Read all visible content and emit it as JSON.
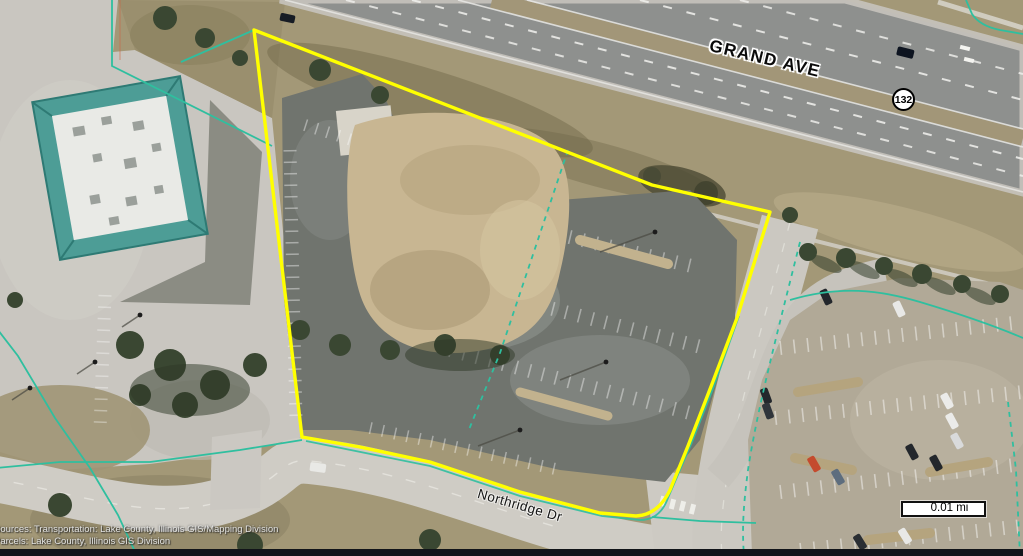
{
  "map": {
    "street_labels": {
      "grand_ave": "GRAND AVE",
      "northridge_dr": "Northridge Dr"
    },
    "route_shield": {
      "number": "132"
    },
    "scale_bar": {
      "label": "0.01 mi"
    },
    "attribution": {
      "line1": "Sources: Transportation: Lake County, Illinois GIS/Mapping Division",
      "line2": "Parcels: Lake County, Illinois GIS Division"
    },
    "colors": {
      "parcel_highlight_outline": "#ffff00",
      "parcel_boundary_lines": "#2fbf9f",
      "route_shield_fill": "#ffffff",
      "route_shield_border": "#000000",
      "street_label_text": "#000000",
      "street_label_halo": "#ffffff",
      "scale_bar_fill": "#ffffff",
      "scale_bar_border": "#111111",
      "attribution_text": "#e2e2e0",
      "building_roof": "#4d9d96"
    },
    "features": {
      "highlighted_parcel": "parcel outlined in yellow",
      "highway": "divided highway at top (Grand Ave, Route 132)",
      "street": "curving street at bottom (Northridge Dr)",
      "building": "teal-roofed building at left",
      "parking_lots": "empty lots inside parcel; occupied lot at lower right"
    }
  }
}
